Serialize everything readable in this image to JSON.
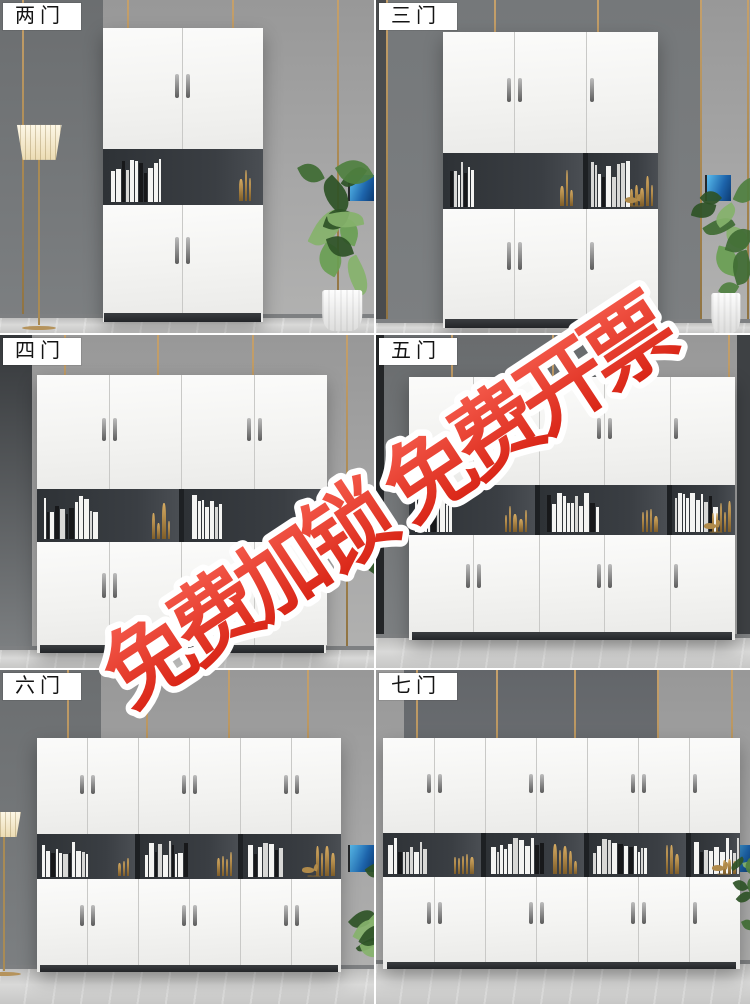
{
  "watermark": {
    "text": "免费加锁 免费开票",
    "fill_color": "#e8352b",
    "outline_color": "#ffffff"
  },
  "panels": [
    {
      "id": "two-door",
      "label": "两门",
      "doors": 2
    },
    {
      "id": "three-door",
      "label": "三门",
      "doors": 3
    },
    {
      "id": "four-door",
      "label": "四门",
      "doors": 4
    },
    {
      "id": "five-door",
      "label": "五门",
      "doors": 5
    },
    {
      "id": "six-door",
      "label": "六门",
      "doors": 6
    },
    {
      "id": "seven-door",
      "label": "七门",
      "doors": 7
    }
  ],
  "scene_palette": {
    "cabinet_white": "#f5f5f3",
    "shelf_interior": "#33373b",
    "wall_light": "#a7a7a7",
    "wall_dark": "#6b6e70",
    "gold_trim": "#b3905e",
    "floor_marble": "#cfcfce",
    "plant_green": "#4f8040",
    "brass_decor": "#c9a35f",
    "tv_screen_blue": "#1d64ab"
  }
}
